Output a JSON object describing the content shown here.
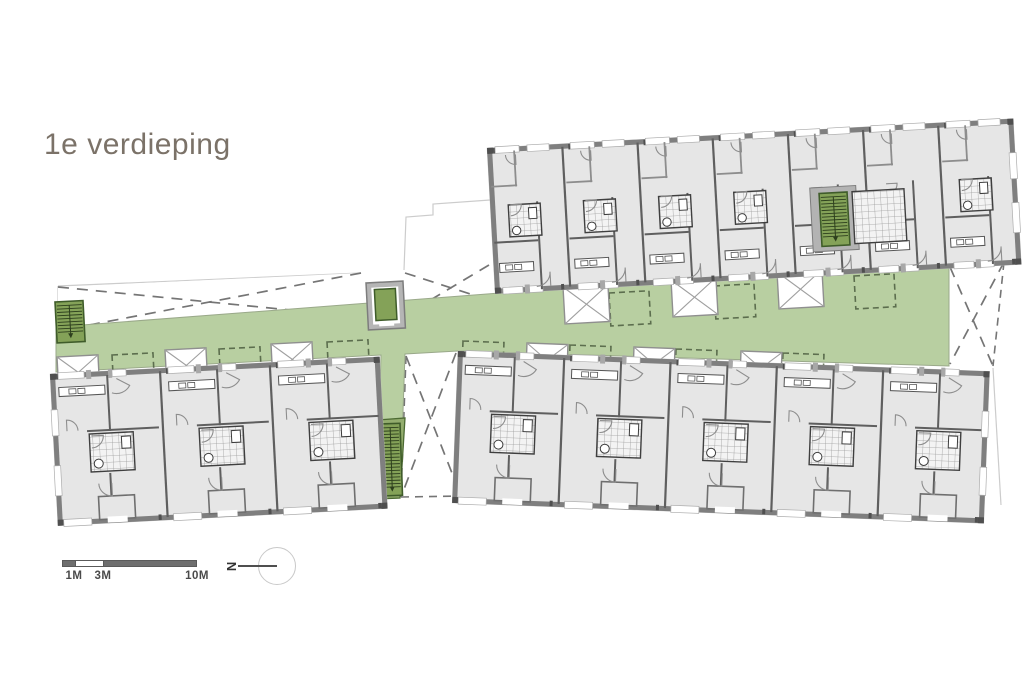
{
  "title": {
    "text": "1e verdieping",
    "color": "#7b7268"
  },
  "scalebar": {
    "labels": [
      "1M",
      "3M",
      "10M"
    ],
    "bar_color": "#6e6e6e"
  },
  "north_indicator": {
    "letter": "N"
  },
  "plan": {
    "colors": {
      "room": "#e6e6e6",
      "wall": "#7f7f7f",
      "wallmid": "#5f5f5f",
      "thin": "#8d8d8d",
      "green": "#b8cfa1",
      "green_dark": "#93ad6e",
      "stair_fill": "#84a258",
      "stair_edge": "#3f5c2a",
      "tread": "#2d3f1d",
      "dash": "#757575",
      "patio": "#5c6e4e",
      "site": "#cccccc",
      "tilebg": "#f3f3f3",
      "tileline": "#9c9c9c",
      "fixture": "#3c3c3c",
      "module": "#a8a8a8",
      "shaft_edge": "#8f8f8f",
      "corner": "#4f4f4f"
    },
    "site_outline": [
      [
        [
          58,
          286
        ],
        [
          361,
          273
        ]
      ],
      [
        [
          404,
          270
        ],
        [
          406,
          217
        ],
        [
          433,
          215
        ],
        [
          433,
          204
        ],
        [
          490,
          200
        ]
      ],
      [
        [
          58,
          286
        ],
        [
          58,
          330
        ]
      ],
      [
        [
          993,
          368
        ],
        [
          1001,
          505
        ]
      ]
    ],
    "corridor": {
      "points": [
        [
          56,
          327
        ],
        [
          500,
          293
        ],
        [
          949,
          262
        ],
        [
          949,
          366
        ],
        [
          458,
          351
        ],
        [
          405,
          354
        ],
        [
          400,
          498
        ],
        [
          377,
          499
        ],
        [
          381,
          355
        ],
        [
          56,
          372
        ]
      ],
      "panel": [
        [
          377,
          420
        ],
        [
          405,
          418
        ],
        [
          400,
          498
        ],
        [
          377,
          499
        ]
      ]
    },
    "voids": [
      {
        "points": [
          [
            58,
            287
          ],
          [
            361,
            273
          ],
          [
            361,
            317
          ],
          [
            58,
            331
          ]
        ],
        "edges": []
      },
      {
        "points": [
          [
            405,
            273
          ],
          [
            489,
            265
          ],
          [
            492,
            301
          ],
          [
            407,
            314
          ]
        ],
        "edges": []
      },
      {
        "points": [
          [
            406,
            356
          ],
          [
            456,
            353
          ],
          [
            461,
            496
          ],
          [
            401,
            497
          ]
        ],
        "edges": [
          [
            0,
            3
          ],
          [
            3,
            2
          ]
        ]
      },
      {
        "points": [
          [
            950,
            267
          ],
          [
            1004,
            262
          ],
          [
            993,
            366
          ],
          [
            950,
            364
          ]
        ],
        "edges": [
          [
            1,
            2
          ]
        ]
      }
    ],
    "shafts": [
      {
        "x": 563,
        "y": 287,
        "w": 45,
        "h": 37,
        "a": -3.2
      },
      {
        "x": 671,
        "y": 280,
        "w": 45,
        "h": 37,
        "a": -3.2
      },
      {
        "x": 777,
        "y": 272,
        "w": 45,
        "h": 37,
        "a": -3.2
      },
      {
        "x": 57,
        "y": 357,
        "w": 41,
        "h": 33,
        "a": -3.0
      },
      {
        "x": 165,
        "y": 350,
        "w": 41,
        "h": 33,
        "a": -3.0
      },
      {
        "x": 271,
        "y": 344,
        "w": 41,
        "h": 33,
        "a": -3.0
      },
      {
        "x": 527,
        "y": 343,
        "w": 41,
        "h": 33,
        "a": 2.2
      },
      {
        "x": 634,
        "y": 347,
        "w": 41,
        "h": 33,
        "a": 2.2
      },
      {
        "x": 741,
        "y": 351,
        "w": 41,
        "h": 33,
        "a": 2.2
      }
    ],
    "patios": [
      {
        "x": 609,
        "y": 293,
        "w": 40,
        "h": 33,
        "a": -3.2
      },
      {
        "x": 714,
        "y": 286,
        "w": 40,
        "h": 33,
        "a": -3.2
      },
      {
        "x": 854,
        "y": 276,
        "w": 40,
        "h": 33,
        "a": -3.2
      },
      {
        "x": 112,
        "y": 355,
        "w": 41,
        "h": 32,
        "a": -3.0
      },
      {
        "x": 219,
        "y": 349,
        "w": 41,
        "h": 32,
        "a": -3.0
      },
      {
        "x": 327,
        "y": 342,
        "w": 41,
        "h": 32,
        "a": -3.0
      },
      {
        "x": 463,
        "y": 341,
        "w": 41,
        "h": 32,
        "a": 2.2
      },
      {
        "x": 570,
        "y": 345,
        "w": 41,
        "h": 32,
        "a": 2.2
      },
      {
        "x": 676,
        "y": 349,
        "w": 41,
        "h": 32,
        "a": 2.2
      },
      {
        "x": 783,
        "y": 353,
        "w": 41,
        "h": 32,
        "a": 2.2
      }
    ],
    "stairs": [
      {
        "x": 55,
        "y": 302,
        "w": 28,
        "h": 41,
        "a": -3.0
      },
      {
        "x": 380,
        "y": 424,
        "w": 20,
        "h": 72,
        "a": -2.0
      }
    ],
    "elevator": {
      "x": 366,
      "y": 283,
      "w": 37,
      "h": 47,
      "a": -3.0
    },
    "blocks": [
      {
        "id": "north-block",
        "x": 487,
        "y": 148,
        "a": -3.2,
        "w": 527,
        "h": 146,
        "units": 7,
        "variant": "north"
      },
      {
        "id": "southwest-block",
        "x": 50,
        "y": 374,
        "a": -3.0,
        "w": 330,
        "h": 152,
        "units": 3,
        "variant": "south"
      },
      {
        "id": "southeast-block",
        "x": 458,
        "y": 351,
        "a": 2.2,
        "w": 532,
        "h": 152,
        "units": 5,
        "variant": "south"
      }
    ]
  }
}
